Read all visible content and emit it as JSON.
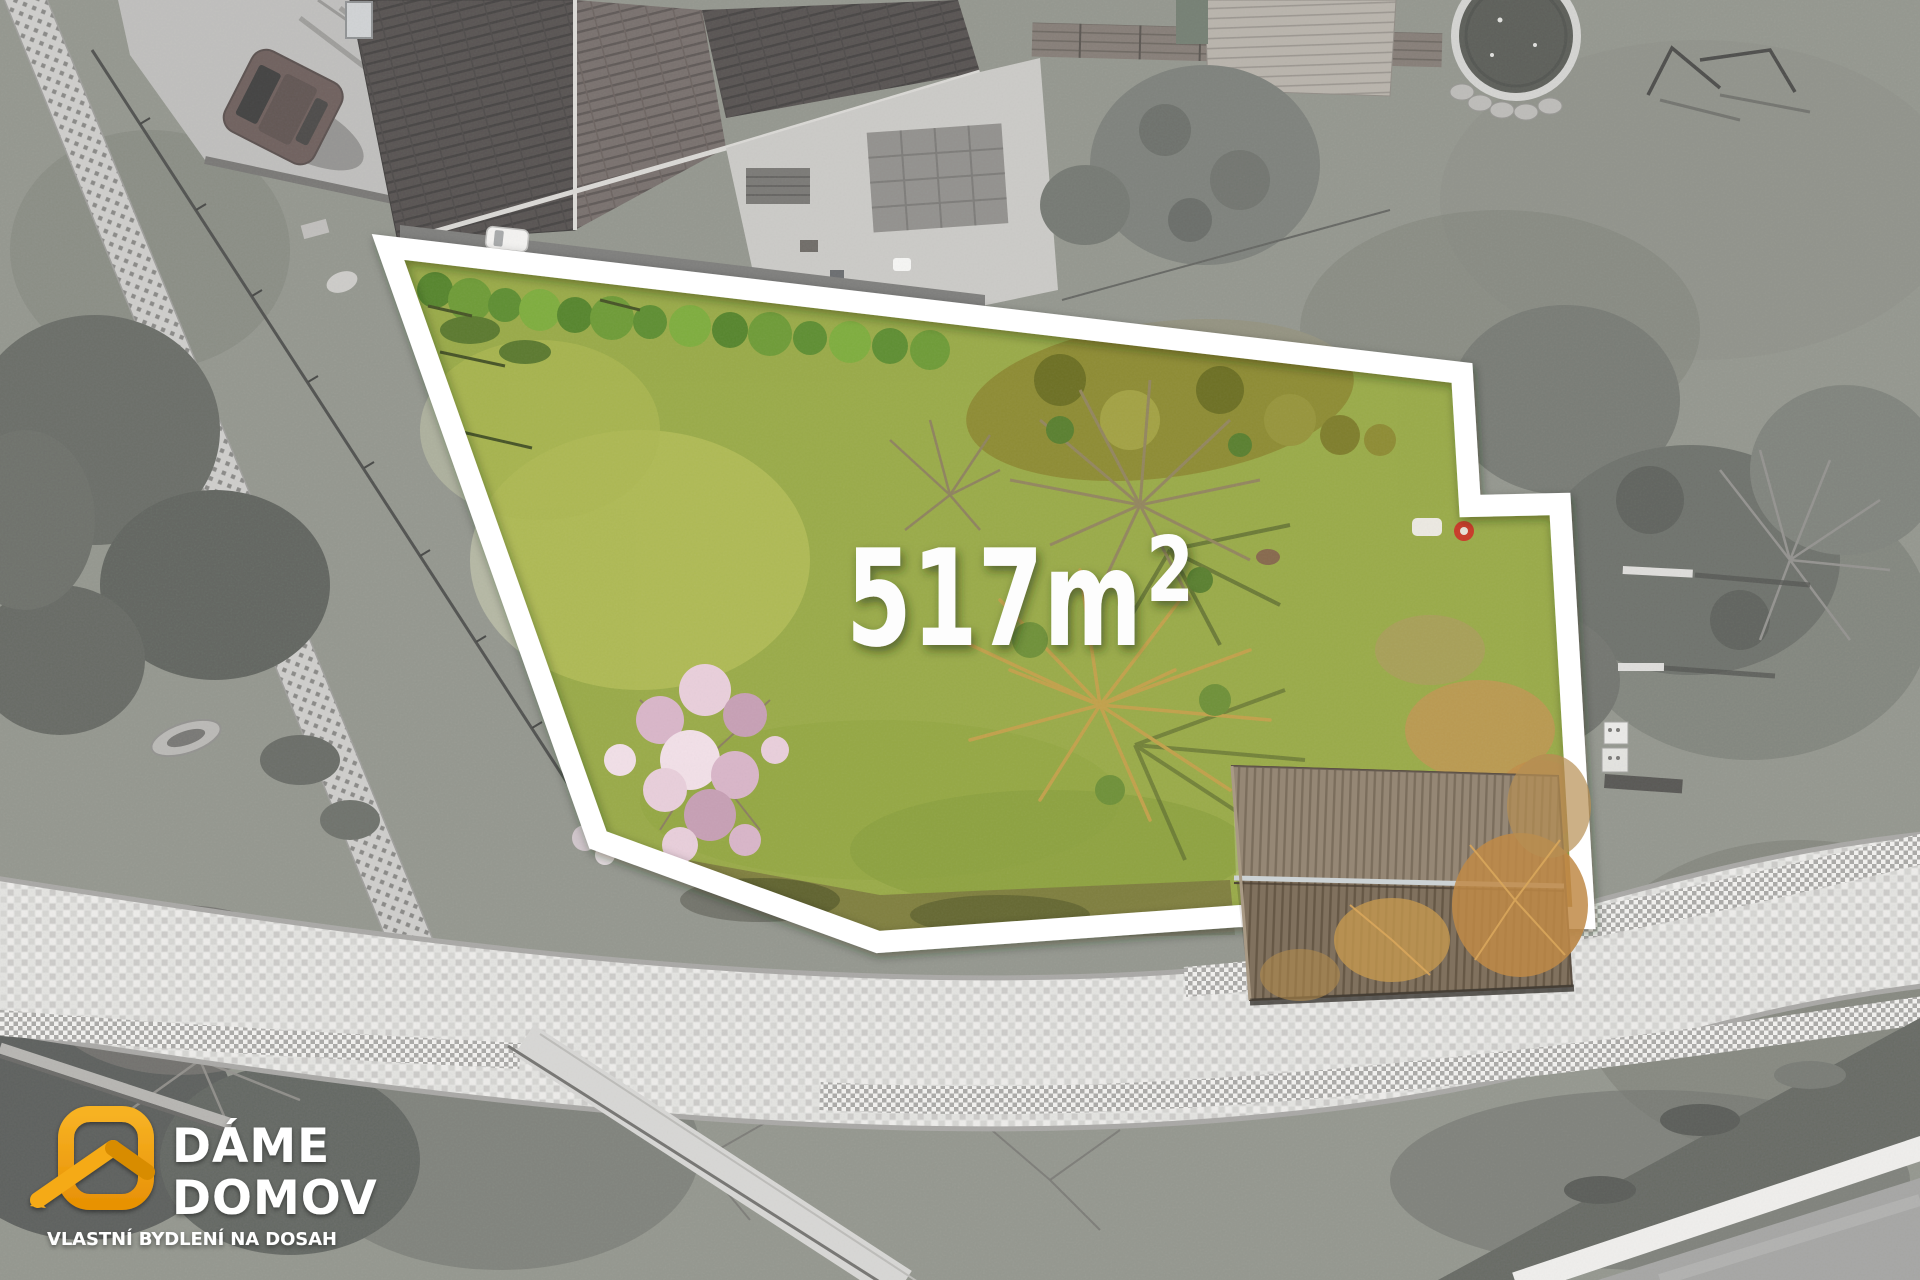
{
  "plot": {
    "area_label": "517m",
    "area_superscript": "2",
    "area_full": "517m²",
    "boundary_color": "#ffffff"
  },
  "watermark": {
    "brand_line1": "DÁME",
    "brand_line2": "DOMOV",
    "tagline": "VLASTNÍ BYDLENÍ NA DOSAH",
    "brand_color": "#F2A10E",
    "text_color": "#ffffff"
  },
  "palette": {
    "plot_grass": "#9aab49",
    "outside_ground": "#87906f",
    "roof_brown": "#50403a",
    "cobble_path": "#d9d7d0",
    "asphalt": "#9c9c98"
  }
}
